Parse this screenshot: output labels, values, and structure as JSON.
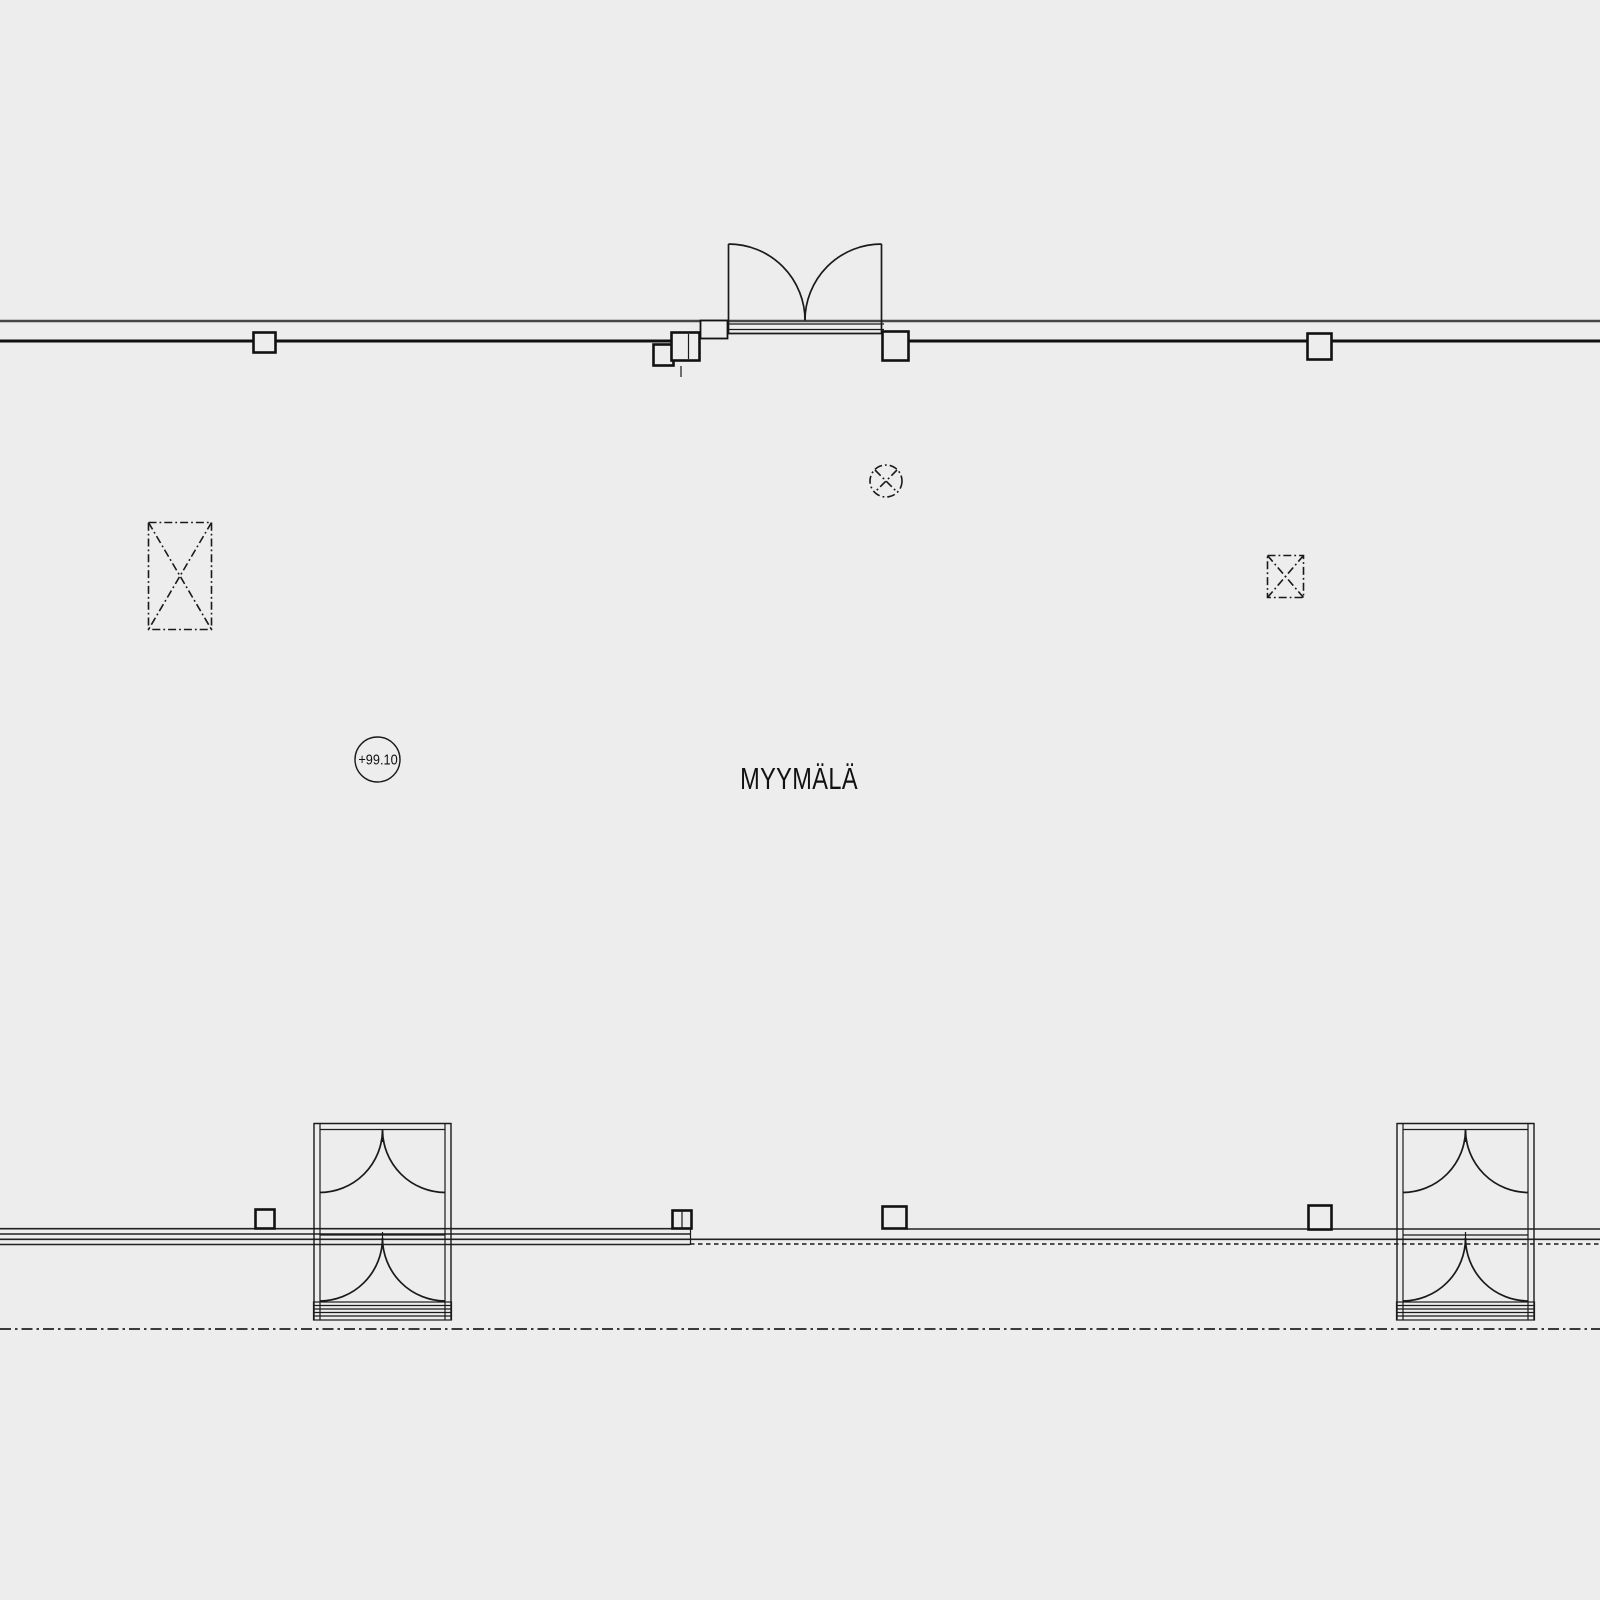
{
  "canvas": {
    "background_color": "#ededed",
    "line_color": "#1a1a1a",
    "wall_accent_color": "#474747",
    "width_px": 1600,
    "height_px": 1600
  },
  "plan": {
    "room_label": "MYYMÄLÄ",
    "level_marker_value": "+99.10"
  },
  "symbols": {
    "top_door": "double-swing-entrance-door",
    "vestibule": "entrance-vestibule-with-double-doors",
    "dashed_rect_left": "opening-above-symbol",
    "dashed_square_right": "opening-above-symbol",
    "dashed_circle_center": "round-opening-above-symbol",
    "column": "structural-column",
    "bottom_line": "dash-dot-reference-line",
    "storefront": "glazed-storefront-wall"
  }
}
